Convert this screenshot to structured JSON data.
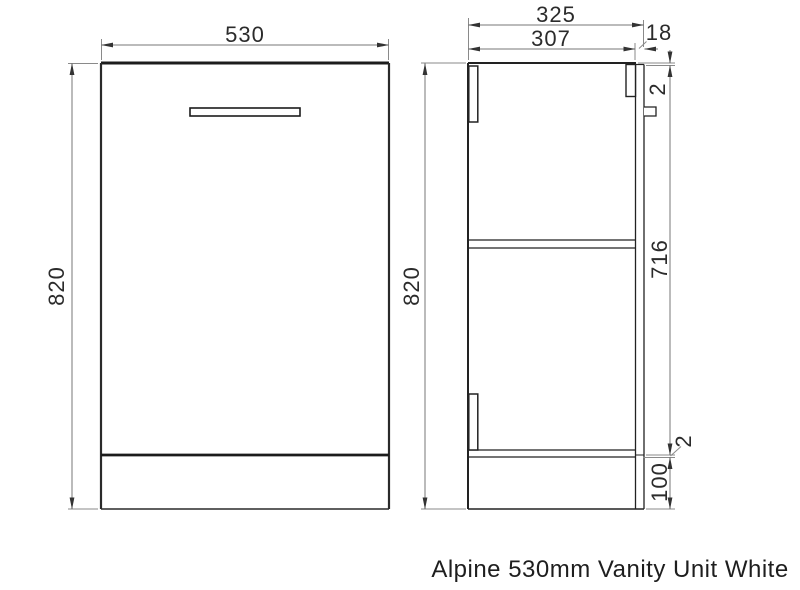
{
  "drawing": {
    "caption": "Alpine 530mm Vanity Unit White",
    "front_view": {
      "width_label": "530",
      "height_label": "820"
    },
    "side_view": {
      "overall_depth_label": "325",
      "internal_depth_label": "307",
      "back_panel_thickness_label": "18",
      "height_label": "820",
      "top_gap_label": "2",
      "door_height_label": "716",
      "bottom_gap_label": "2",
      "plinth_height_label": "100"
    },
    "colors": {
      "object_line": "#1c1c1c",
      "dimension_line": "#808080",
      "arrow": "#333333",
      "background": "#ffffff"
    }
  }
}
